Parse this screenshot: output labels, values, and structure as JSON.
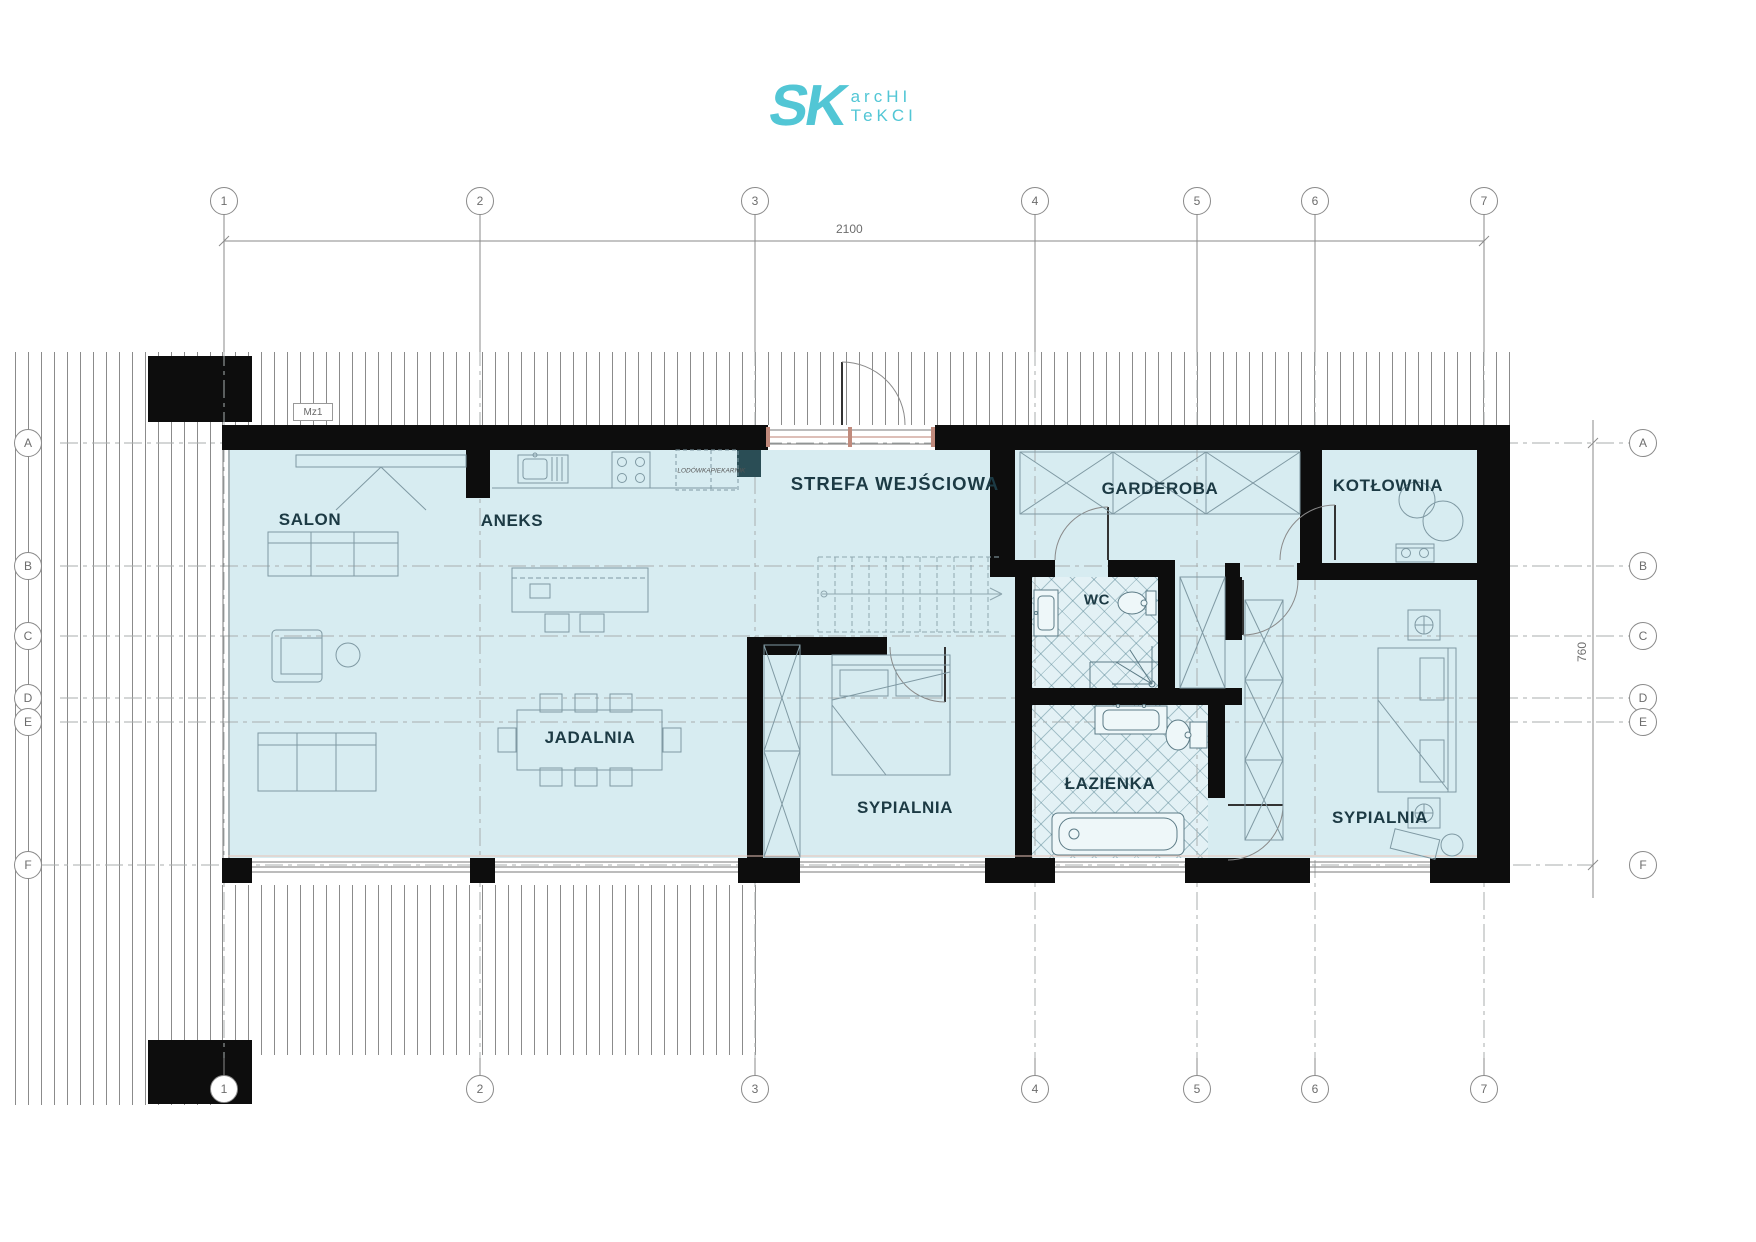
{
  "logo": {
    "sk": "SK",
    "line1": "arcHI",
    "line2": "TeKCI"
  },
  "grid": {
    "columns": [
      "1",
      "2",
      "3",
      "4",
      "5",
      "6",
      "7"
    ],
    "rows": [
      "A",
      "B",
      "C",
      "D",
      "E",
      "F"
    ],
    "dim_width": "2100",
    "dim_height": "760"
  },
  "rooms": {
    "salon": "SALON",
    "aneks": "ANEKS",
    "strefa": "STREFA WEJŚCIOWA",
    "garderoba": "GARDEROBA",
    "kotlownia": "KOTŁOWNIA",
    "wc": "WC",
    "jadalnia": "JADALNIA",
    "sypialnia1": "SYPIALNIA",
    "lazienka": "ŁAZIENKA",
    "sypialnia2": "SYPIALNIA"
  },
  "annotations": {
    "marker": "Mz1",
    "fridge": "LODÓWKA",
    "oven": "PIEKARNIK"
  },
  "colors": {
    "accent_teal": "#52c6d5",
    "room_fill": "#d7ecf1",
    "label": "#1c3a44",
    "wall": "#0d0d0d",
    "column_teal": "#2a4d55"
  }
}
